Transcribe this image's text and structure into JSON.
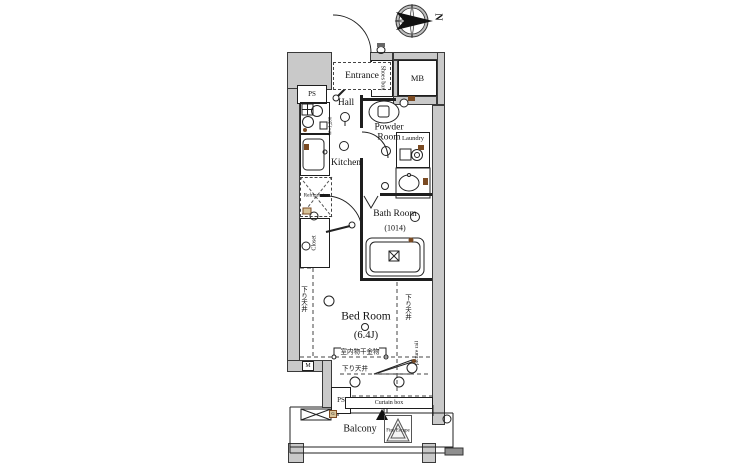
{
  "compass": {
    "north_label": "N"
  },
  "rooms": {
    "entrance": "Entrance",
    "hall": "Hall",
    "kitchen": "Kitchen",
    "powder_room": "Powder Room",
    "laundry": "Laundry",
    "bath_room": "Bath Room",
    "bath_room_size": "(1014)",
    "bed_room": "Bed Room",
    "bed_room_size": "(6.4J)",
    "balcony": "Balcony",
    "meter_box": "MB",
    "closet": "Closet"
  },
  "features": {
    "shoes_box": "Shoes box",
    "refrigerator": "Refrigerator",
    "kitchen_counter_width": "W=1,200",
    "curtain_box": "Curtain box",
    "picture_rail": "picture rail",
    "fire_escape": "Fire Escape",
    "pipe_space_top": "PS",
    "pipe_space_bottom": "PS",
    "meter": "M",
    "gas_meter": "G"
  },
  "annotations": {
    "lowered_ceiling_left": "下り天井",
    "lowered_ceiling_right": "下り天井",
    "lowered_ceiling_bottom": "下り天井",
    "indoor_drying_fixture": "室内物干金物"
  },
  "colors": {
    "wall_fill": "#c9c9c9",
    "line": "#1e1e1e",
    "accent_brown": "#7a4a22",
    "background": "#ffffff"
  }
}
